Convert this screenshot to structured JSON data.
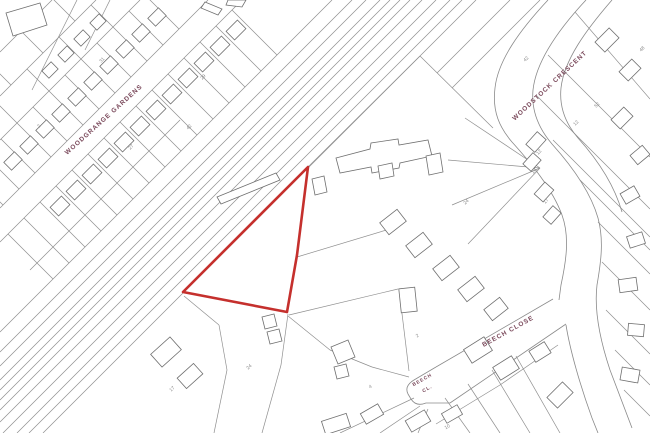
{
  "map": {
    "title": "Site location plan",
    "background_color": "#ffffff",
    "parcel_line_color": "#8f8f8f",
    "building_line_color": "#6f6f6f",
    "street_label_color": "#7b4a5c",
    "house_number_color": "#8a8a8a",
    "plot_boundary": {
      "color": "#c5302d",
      "stroke_width": 2.6,
      "points": "308,167 297,255 287,312 183,292"
    },
    "street_labels": [
      {
        "text": "WOODGRANGE GARDENS",
        "x": 105,
        "y": 121,
        "rotate": -42,
        "size": 6.5
      },
      {
        "text": "WOODSTOCK CRESCENT",
        "x": 551,
        "y": 87,
        "rotate": -43,
        "size": 6.5
      },
      {
        "text": "BEECH CLOSE",
        "x": 509,
        "y": 333,
        "rotate": -29,
        "size": 6.5
      },
      {
        "text": "BEECH",
        "x": 423,
        "y": 381,
        "rotate": -29,
        "size": 4.8
      },
      {
        "text": "CL.",
        "x": 428,
        "y": 390,
        "rotate": -29,
        "size": 4.8
      }
    ],
    "house_numbers": [
      {
        "text": "31",
        "x": 103,
        "y": 61,
        "rotate": -45
      },
      {
        "text": "29",
        "x": 204,
        "y": 78,
        "rotate": -45
      },
      {
        "text": "2",
        "x": 40,
        "y": 127,
        "rotate": -45
      },
      {
        "text": "42",
        "x": 190,
        "y": 128,
        "rotate": -45
      },
      {
        "text": "27",
        "x": 132,
        "y": 148,
        "rotate": -45
      },
      {
        "text": "42",
        "x": 527,
        "y": 60,
        "rotate": -45
      },
      {
        "text": "48",
        "x": 643,
        "y": 50,
        "rotate": -45
      },
      {
        "text": "52",
        "x": 598,
        "y": 106,
        "rotate": -45
      },
      {
        "text": "12",
        "x": 577,
        "y": 124,
        "rotate": -45
      },
      {
        "text": "12",
        "x": 540,
        "y": 153,
        "rotate": -48
      },
      {
        "text": "16",
        "x": 535,
        "y": 172,
        "rotate": -48
      },
      {
        "text": "17",
        "x": 547,
        "y": 202,
        "rotate": -48
      },
      {
        "text": "24",
        "x": 467,
        "y": 203,
        "rotate": -40
      },
      {
        "text": "2",
        "x": 418,
        "y": 337,
        "rotate": -30
      },
      {
        "text": "4",
        "x": 371,
        "y": 388,
        "rotate": -30
      },
      {
        "text": "10",
        "x": 448,
        "y": 428,
        "rotate": -30
      },
      {
        "text": "17",
        "x": 173,
        "y": 390,
        "rotate": -42
      },
      {
        "text": "24",
        "x": 250,
        "y": 368,
        "rotate": -42
      }
    ]
  }
}
